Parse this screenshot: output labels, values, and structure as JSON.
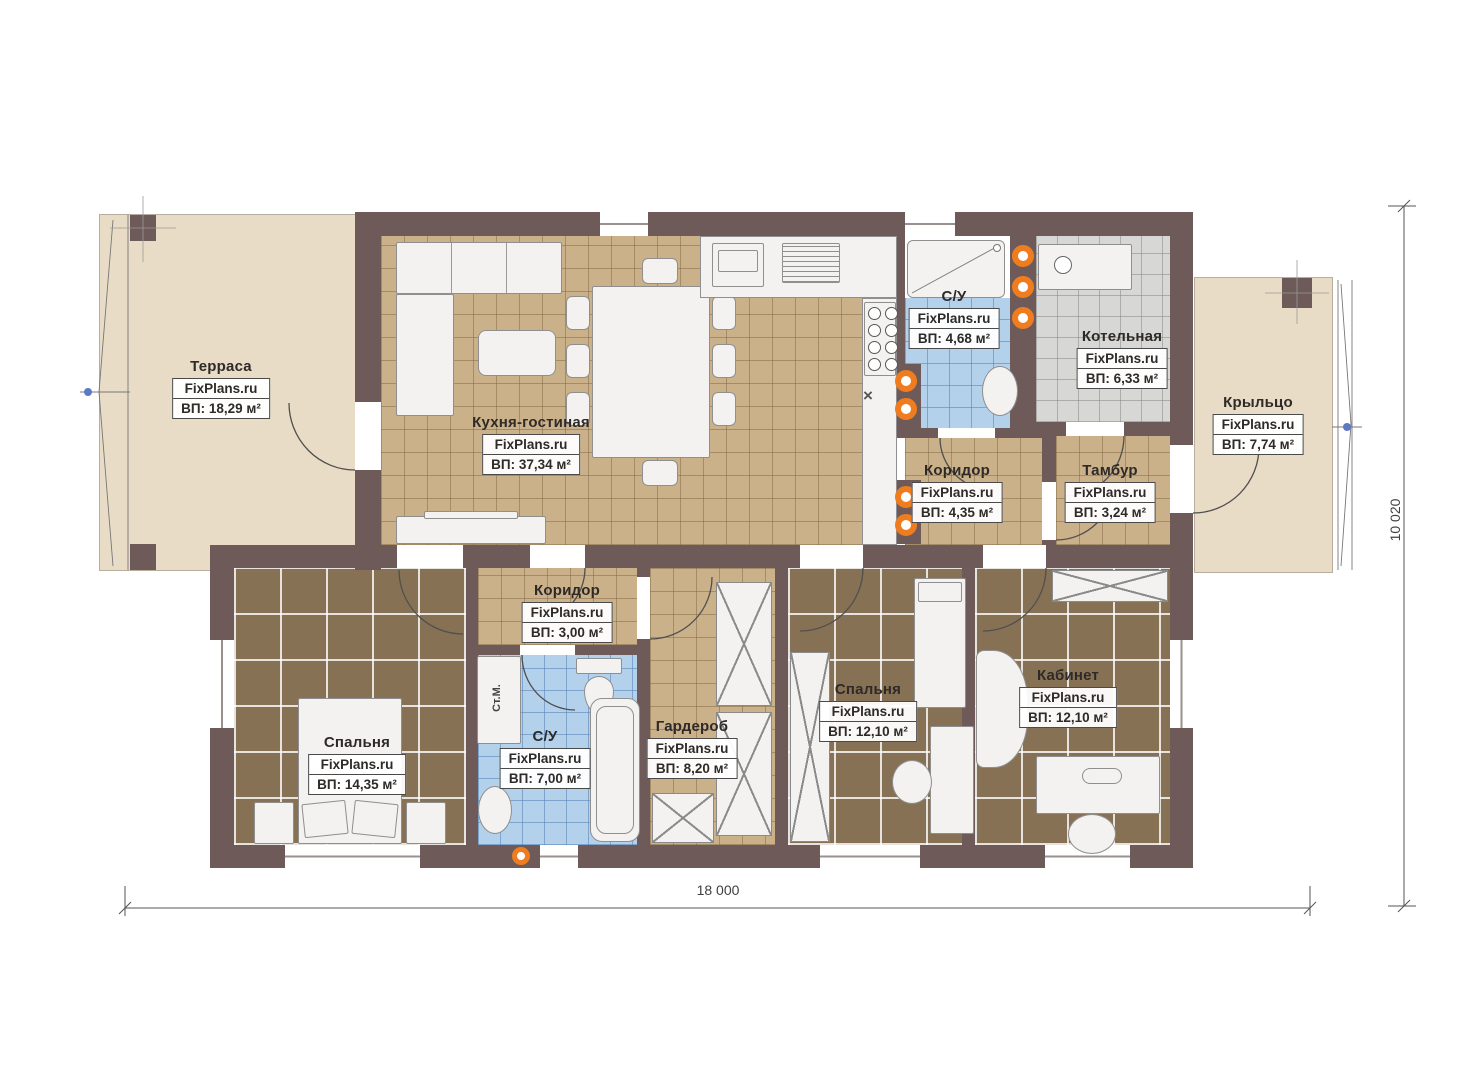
{
  "plan": {
    "watermark": "FixPlans.ru",
    "rooms": [
      {
        "key": "terrace",
        "name": "Терраса",
        "area": "ВП: 18,29 м²"
      },
      {
        "key": "kitchen_living",
        "name": "Кухня-гостиная",
        "area": "ВП: 37,34 м²"
      },
      {
        "key": "bathroom_top",
        "name": "С/У",
        "area": "ВП: 4,68 м²"
      },
      {
        "key": "boiler",
        "name": "Котельная",
        "area": "ВП: 6,33 м²"
      },
      {
        "key": "porch",
        "name": "Крыльцо",
        "area": "ВП: 7,74 м²"
      },
      {
        "key": "corridor_main",
        "name": "Коридор",
        "area": "ВП: 4,35 м²"
      },
      {
        "key": "vestibule",
        "name": "Тамбур",
        "area": "ВП: 3,24 м²"
      },
      {
        "key": "corridor_small",
        "name": "Коридор",
        "area": "ВП: 3,00 м²"
      },
      {
        "key": "bedroom_master",
        "name": "Спальня",
        "area": "ВП: 14,35 м²"
      },
      {
        "key": "bathroom_main",
        "name": "С/У",
        "area": "ВП: 7,00 м²"
      },
      {
        "key": "wardrobe",
        "name": "Гардероб",
        "area": "ВП: 8,20 м²"
      },
      {
        "key": "bedroom_second",
        "name": "Спальня",
        "area": "ВП: 12,10 м²"
      },
      {
        "key": "office",
        "name": "Кабинет",
        "area": "ВП: 12,10 м²"
      }
    ],
    "dimensions": {
      "width": "18 000",
      "height": "10 020"
    },
    "annotations": {
      "washing_machine": "Ст.М.",
      "sink_mark": "×"
    },
    "colors": {
      "wall": "#6e5b59",
      "floor_tan": "#cbb189",
      "floor_dark": "#877155",
      "floor_blue": "#b4d1ec",
      "floor_gray": "#d7d7d5",
      "floor_beige": "#e9dcc6",
      "accent_orange": "#ef7d1f"
    }
  }
}
